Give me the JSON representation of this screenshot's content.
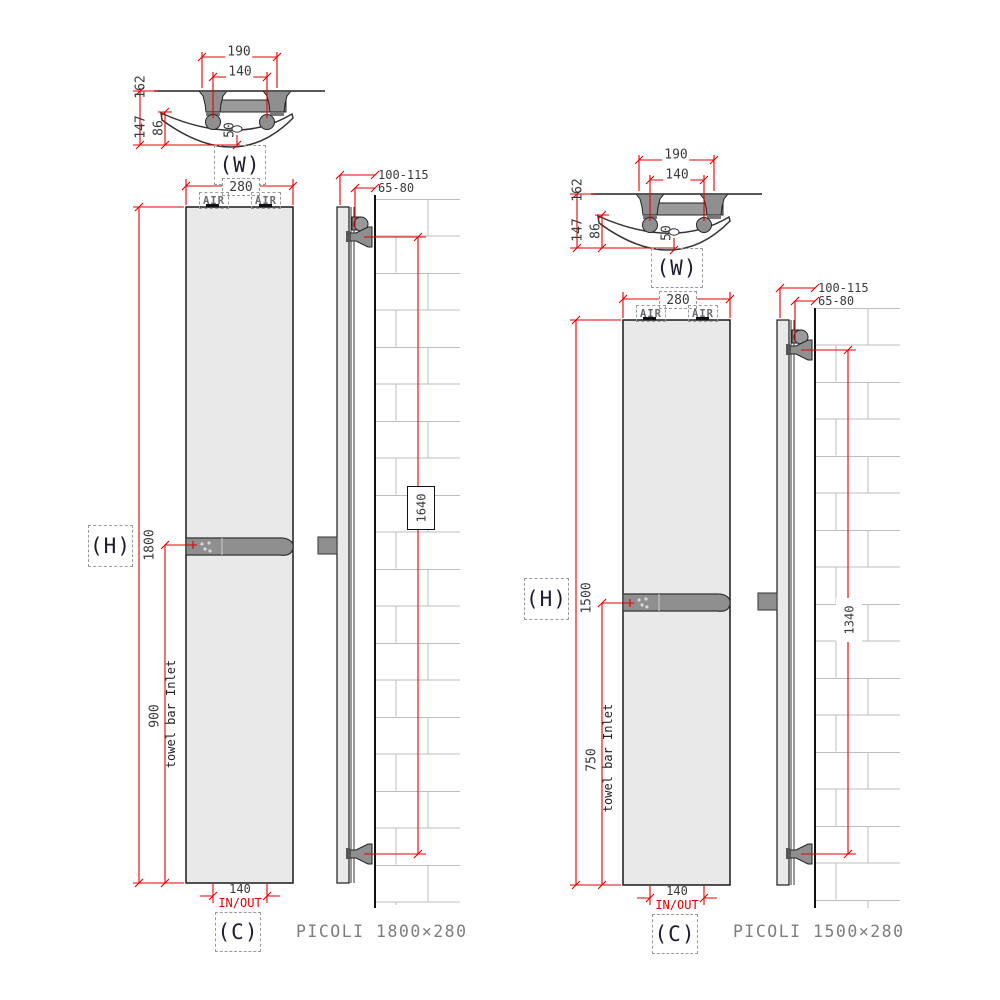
{
  "colors": {
    "dimension_red": "#e60000",
    "panel_fill": "#e9e9e9",
    "metal_gray": "#8f8f8f",
    "brick_line": "#bdbdbd",
    "dim_text": "#3a3a3a"
  },
  "drawings": [
    {
      "caption": "PICOLI 1800×280",
      "labels": {
        "width_ref": "(W)",
        "height_ref": "(H)",
        "center_ref": "(C)"
      },
      "detail": {
        "bracket_span": "190",
        "pipe_span": "140",
        "depth_total": "162",
        "depth_wall": "147",
        "depth_panel": "86",
        "pipe_offset": "50"
      },
      "front": {
        "width": "280",
        "air_left": "AIR",
        "air_right": "AIR",
        "height": "1800",
        "towel_bar_height": "900",
        "towel_bar_note": "towel bar Inlet",
        "inout_span": "140",
        "inout_label": "IN/OUT"
      },
      "side": {
        "wall_distance": "100-115",
        "bracket_distance": "65-80",
        "bracket_span_vertical": "1640"
      }
    },
    {
      "caption": "PICOLI 1500×280",
      "labels": {
        "width_ref": "(W)",
        "height_ref": "(H)",
        "center_ref": "(C)"
      },
      "detail": {
        "bracket_span": "190",
        "pipe_span": "140",
        "depth_total": "162",
        "depth_wall": "147",
        "depth_panel": "86",
        "pipe_offset": "50"
      },
      "front": {
        "width": "280",
        "air_left": "AIR",
        "air_right": "AIR",
        "height": "1500",
        "towel_bar_height": "750",
        "towel_bar_note": "towel bar Inlet",
        "inout_span": "140",
        "inout_label": "IN/OUT"
      },
      "side": {
        "wall_distance": "100-115",
        "bracket_distance": "65-80",
        "bracket_span_vertical": "1340"
      }
    }
  ]
}
